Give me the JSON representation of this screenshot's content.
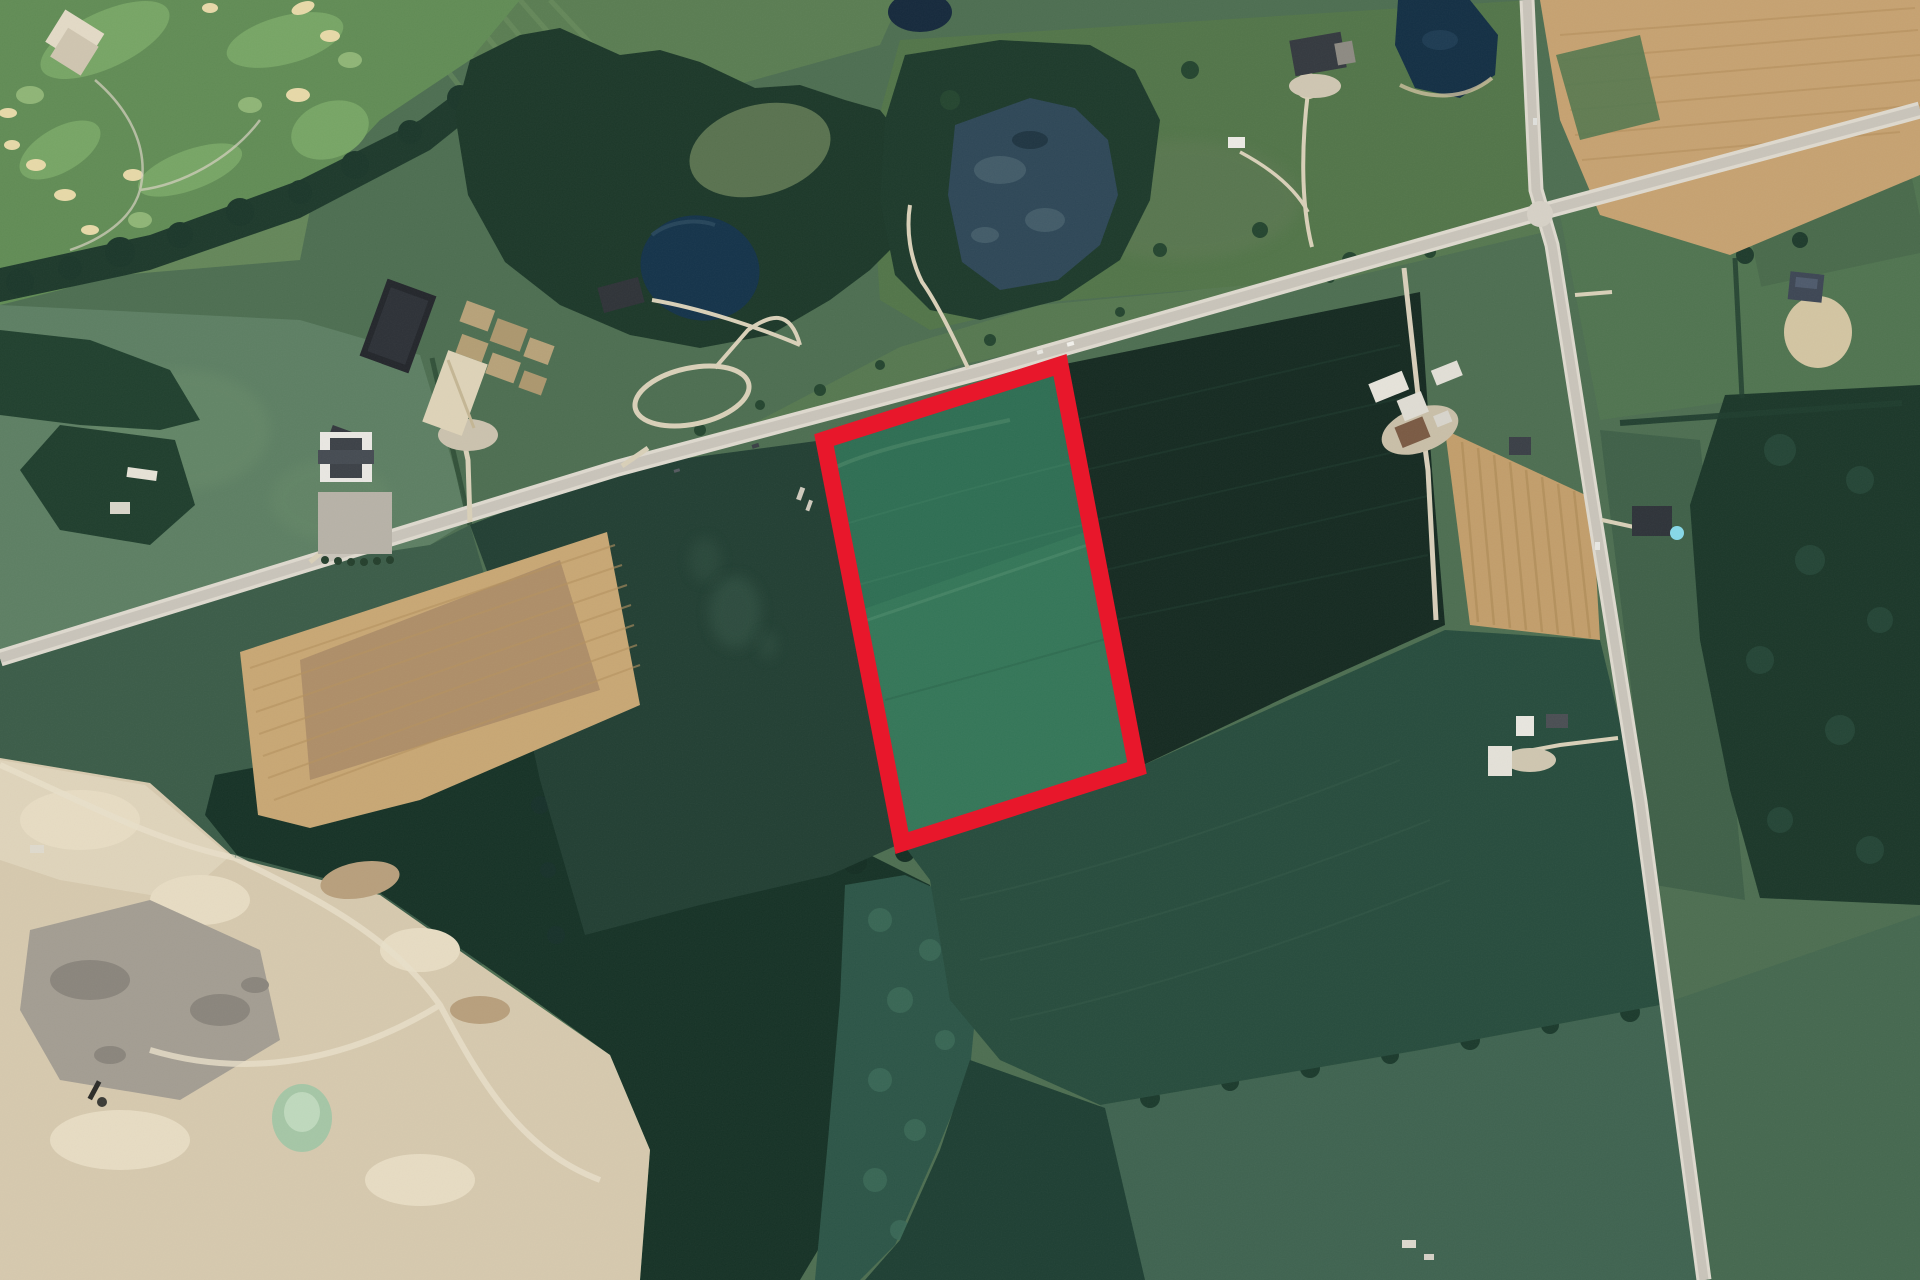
{
  "map": {
    "description": "Aerial satellite view of rural farmland and countryside with one farm parcel outlined by a red boundary overlay",
    "highlight": {
      "shape": "quadrilateral",
      "shape_points": "824,440 1060,365 1137,768 902,843",
      "stroke_color": "#e8172b",
      "stroke_width": "17"
    },
    "palette": {
      "highlight_red": "#e8172b",
      "road_gray": "#cdc8be",
      "water_dark_blue": "#16334a",
      "forest_dark_green": "#1c3829",
      "crop_field_dark": "#152a21",
      "parcel_green": "#2e6e53",
      "sand_pit_tan": "#d6c9ae",
      "plowed_field_tan": "#c8a774",
      "pasture_green": "#5d7f63"
    },
    "features": {
      "golf_course": "golf course with sand bunkers and clubhouse (top left)",
      "forest_blocks": "deciduous forest blocks and hedgerows",
      "ponds": "farm ponds and a wetland marsh",
      "highway": "two-lane rural highway running diagonally",
      "side_road": "north-south concession road on the right",
      "gravel_pit": "sand and gravel pit with green settling pond (bottom left)",
      "plowed_fields": "bare tan plowed fields",
      "farmsteads": "farmsteads with barns, arenas and houses",
      "highlighted_parcel": "green field parcel outlined in red"
    }
  }
}
